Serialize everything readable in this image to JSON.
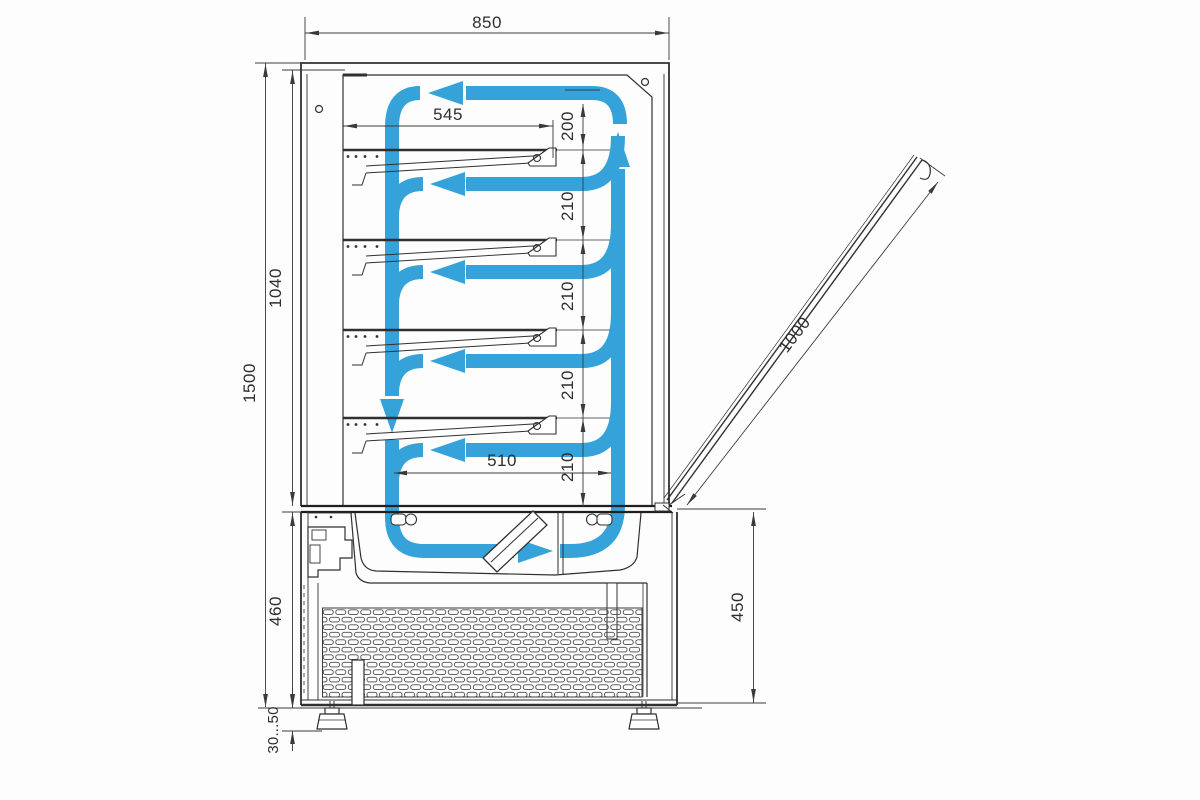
{
  "drawing": {
    "kind": "refrigerated-display-case-side-section",
    "colors": {
      "flow_blue": "#35a3da",
      "line_dark": "#333333"
    },
    "dims": {
      "overall_width": "850",
      "shelf_depth": "545",
      "air_gap_top": "200",
      "gap_210_1": "210",
      "gap_210_2": "210",
      "gap_210_3": "210",
      "gap_210_4": "210",
      "glass_section_height": "1040",
      "overall_height": "1500",
      "bottom_shelf_width": "510",
      "base_height_left": "460",
      "base_height_right": "450",
      "door_glass_length": "1000",
      "leg_adjust_range": "30...50"
    }
  }
}
